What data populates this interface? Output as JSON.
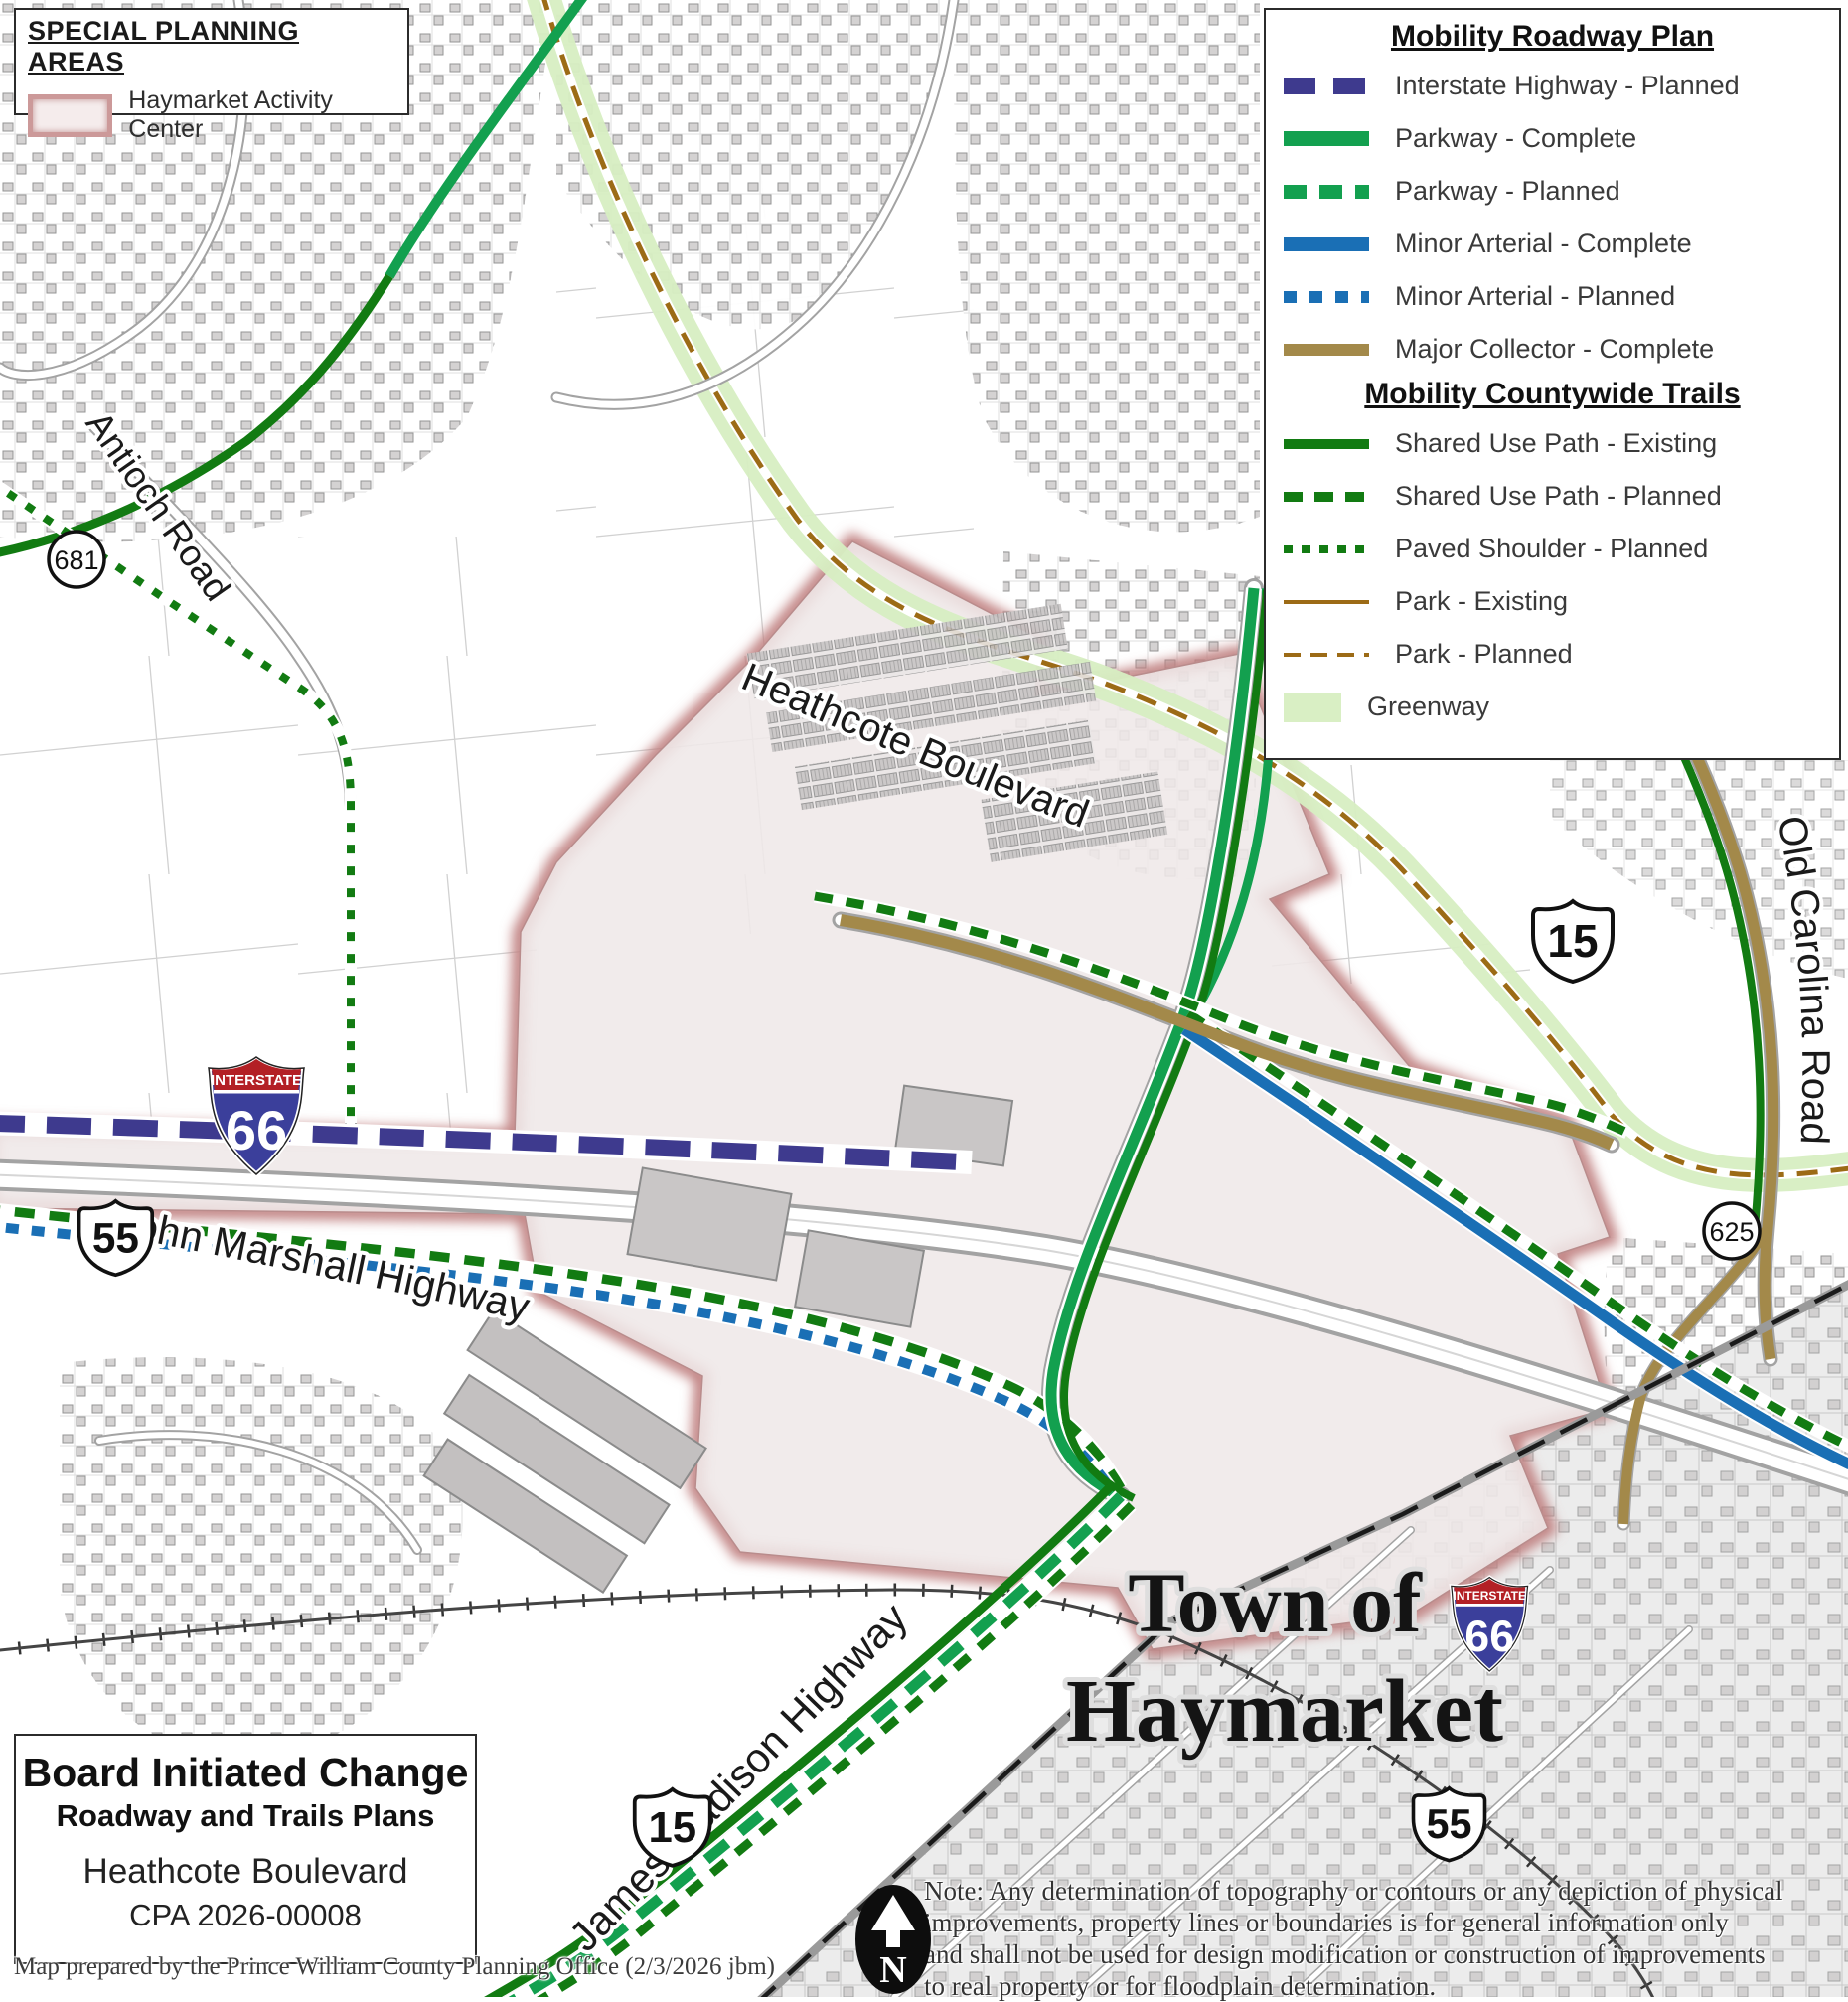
{
  "colors": {
    "interstate_planned": "#3e3a8e",
    "parkway_green": "#13a04f",
    "minor_arterial_blue": "#1a6fb5",
    "major_collector_tan": "#a3894a",
    "shared_use_path_green": "#127b12",
    "park_brown": "#9c6b16",
    "greenway_fill": "#d9efc4",
    "activity_center_fill": "#efe8e8",
    "activity_center_glow": "#c08080"
  },
  "special_planning": {
    "title": "SPECIAL PLANNING AREAS",
    "item": "Haymarket Activity Center"
  },
  "mobility_legend": {
    "roadway_title": "Mobility Roadway Plan",
    "roadway_items": [
      "Interstate Highway - Planned",
      "Parkway - Complete",
      "Parkway - Planned",
      "Minor Arterial - Complete",
      "Minor Arterial - Planned",
      "Major Collector - Complete"
    ],
    "trails_title": "Mobility Countywide Trails",
    "trails_items": [
      "Shared Use Path - Existing",
      "Shared Use Path - Planned",
      "Paved Shoulder - Planned",
      "Park - Existing",
      "Park - Planned",
      "Greenway"
    ]
  },
  "roads": {
    "antioch": "Antioch Road",
    "heathcote": "Heathcote Boulevard",
    "john_marshall": "John Marshall Highway",
    "james_madison": "James Madison Highway",
    "old_carolina": "Old Carolina Road"
  },
  "town_label": {
    "line1": "Town of",
    "line2": "Haymarket"
  },
  "shields": {
    "interstate_banner": "INTERSTATE",
    "i66": "66",
    "us15": "15",
    "va55": "55",
    "sr681": "681",
    "sr625": "625"
  },
  "title_block": {
    "line1": "Board Initiated Change",
    "line2": "Roadway and Trails Plans",
    "line3": "Heathcote Boulevard",
    "line4": "CPA 2026-00008"
  },
  "note": {
    "line1": "Note: Any determination of topography or contours or any depiction of physical",
    "line2": "improvements, property lines or boundaries is for general information only",
    "line3": "and shall not be used for design modification or construction of improvements",
    "line4": "to real property or for floodplain determination."
  },
  "credit": "Map prepared by the Prince William County Planning Office (2/3/2026 jbm)",
  "north_arrow_letter": "N"
}
